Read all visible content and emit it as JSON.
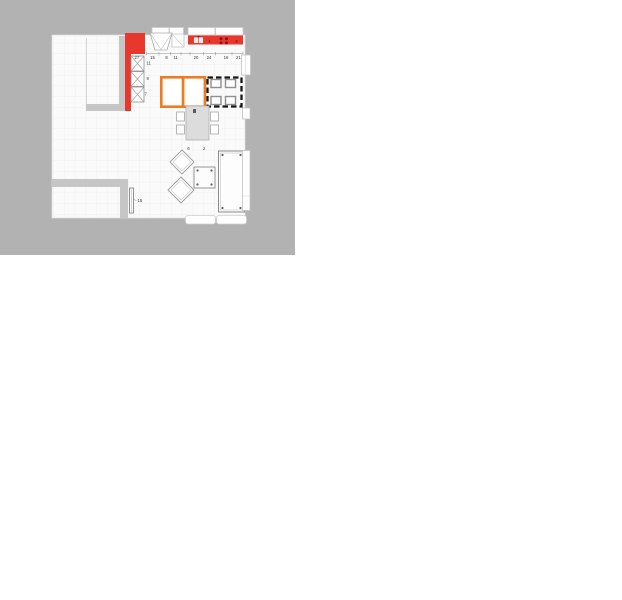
{
  "workspace": {
    "bg": "#b2b2b2",
    "page_bg": "#ffffff"
  },
  "palette": {
    "red": "#e8382e",
    "orange": "#ee7b1e",
    "selection_black": "#161616",
    "wall_gray": "#c6c6c6",
    "wall_gray_light": "#cdcdcd",
    "floor": "#fafafa",
    "grid_line": "#ededed",
    "object_outline": "#8f8f8f",
    "table_fill": "#dcdcdc"
  },
  "plan": {
    "top_dimensions": [
      "15",
      "8",
      "11",
      "20",
      "24",
      "16",
      "21"
    ],
    "left_cabinet_dims": [
      "27",
      "11",
      "9",
      "7"
    ],
    "counter_marks": [
      "4",
      "8"
    ],
    "dining_dims": [
      "6",
      "2"
    ],
    "radiator_dim": "15"
  }
}
